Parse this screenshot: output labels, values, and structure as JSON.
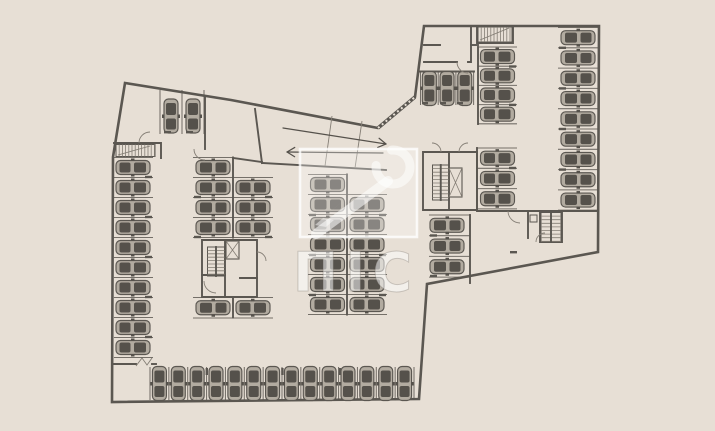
{
  "canvas": {
    "w": 715,
    "h": 431,
    "bg": "#e7dfd5",
    "wall": "#5b5751",
    "thin": "#847e75",
    "arrow": "#55514b",
    "car_dark": "#55514b",
    "car_body": "#b2aba0",
    "white": "#ffffff"
  },
  "watermark": {
    "letters": "ПІС",
    "square": [
      300,
      149,
      117,
      88
    ],
    "letters_center": [
      356,
      291
    ]
  },
  "plan": {
    "outline": [
      [
        125,
        83
      ],
      [
        231,
        100
      ],
      [
        378,
        128
      ],
      [
        415,
        97
      ],
      [
        424,
        26
      ],
      [
        599,
        26
      ],
      [
        598,
        252
      ],
      [
        427,
        284
      ],
      [
        419,
        399
      ],
      [
        112,
        402
      ],
      [
        113,
        157
      ],
      [
        125,
        83
      ]
    ],
    "hatched": [
      [
        [
          378,
          128
        ],
        [
          415,
          97
        ]
      ]
    ],
    "walls": [
      [
        [
          114,
          143
        ],
        [
          161,
          143
        ],
        [
          161,
          158
        ]
      ],
      [
        [
          205,
          96
        ],
        [
          205,
          149
        ]
      ],
      [
        [
          255,
          109
        ],
        [
          262,
          163
        ]
      ],
      [
        [
          262,
          163
        ],
        [
          386,
          170
        ]
      ],
      [
        [
          233,
          158
        ],
        [
          262,
          162
        ]
      ],
      [
        [
          233,
          157.5
        ],
        [
          233,
          237.5
        ]
      ],
      [
        [
          233,
          297.5
        ],
        [
          233,
          317.5
        ]
      ],
      [
        [
          347,
          174.5
        ],
        [
          347,
          314.5
        ]
      ],
      [
        [
          202,
          240
        ],
        [
          257,
          240
        ],
        [
          257,
          297
        ],
        [
          202,
          297
        ],
        [
          202,
          240
        ]
      ],
      [
        [
          225,
          240
        ],
        [
          225,
          297
        ]
      ],
      [
        [
          202,
          275
        ],
        [
          225,
          275
        ]
      ],
      [
        [
          240,
          278
        ],
        [
          257,
          278
        ]
      ],
      [
        [
          423,
          152
        ],
        [
          477,
          152
        ],
        [
          477,
          210
        ],
        [
          423,
          210
        ],
        [
          423,
          152
        ]
      ],
      [
        [
          449,
          152
        ],
        [
          449,
          210
        ]
      ],
      [
        [
          424,
          62
        ],
        [
          457,
          62
        ]
      ],
      [
        [
          468,
          62
        ],
        [
          471,
          62
        ],
        [
          471,
          26
        ]
      ],
      [
        [
          471,
          45
        ],
        [
          478,
          45
        ]
      ],
      [
        [
          424,
          45
        ],
        [
          440,
          45
        ]
      ],
      [
        [
          477,
          26
        ],
        [
          477,
          43
        ],
        [
          513,
          43
        ],
        [
          513,
          26
        ]
      ],
      [
        [
          419,
          71.5
        ],
        [
          474,
          71.5
        ]
      ],
      [
        [
          478,
          47
        ],
        [
          478,
          124
        ]
      ],
      [
        [
          477,
          148
        ],
        [
          477,
          209
        ]
      ],
      [
        [
          477,
          211
        ],
        [
          598,
          211
        ]
      ],
      [
        [
          540,
          211
        ],
        [
          540,
          242
        ],
        [
          562,
          242
        ],
        [
          562,
          211
        ]
      ],
      [
        [
          528,
          211
        ],
        [
          528,
          238
        ]
      ],
      [
        [
          470,
          215
        ],
        [
          470,
          283
        ]
      ],
      [
        [
          114,
          364
        ],
        [
          136,
          364
        ]
      ],
      [
        [
          152,
          364
        ],
        [
          156,
          364
        ]
      ]
    ],
    "thin": [
      [
        [
          332,
          116
        ],
        [
          325,
          166
        ]
      ],
      [
        [
          362,
          121
        ],
        [
          355,
          168
        ]
      ],
      [
        [
          118,
          155
        ],
        [
          150,
          146
        ]
      ],
      [
        [
          480,
          40
        ],
        [
          509,
          28
        ]
      ],
      [
        [
          136,
          366
        ],
        [
          142,
          358
        ],
        [
          147,
          365
        ],
        [
          152,
          358
        ]
      ]
    ],
    "stall_groups": [
      {
        "name": "left-wall-column",
        "orient": "h",
        "x1": 114,
        "x2": 153,
        "start": 157.5,
        "step": 20,
        "count": 10,
        "carC": 133,
        "rot": 0
      },
      {
        "name": "center-left-col-west",
        "orient": "h",
        "x1": 193,
        "x2": 233,
        "start": 157.5,
        "step": 20,
        "count": 4,
        "carC": 213,
        "rot": 180
      },
      {
        "name": "center-left-col-east",
        "orient": "h",
        "x1": 233,
        "x2": 273,
        "start": 177.5,
        "step": 20,
        "count": 3,
        "carC": 253,
        "rot": 0
      },
      {
        "name": "center-left-col-west-lower",
        "orient": "h",
        "x1": 193,
        "x2": 233,
        "start": 297.5,
        "step": 20.5,
        "count": 1,
        "carC": 213,
        "rot": 180
      },
      {
        "name": "center-left-col-east-lower",
        "orient": "h",
        "x1": 233,
        "x2": 273,
        "start": 297.5,
        "step": 20.5,
        "count": 1,
        "carC": 253,
        "rot": 0
      },
      {
        "name": "center-right-col-west",
        "orient": "h",
        "x1": 308,
        "x2": 347,
        "start": 174.5,
        "step": 20,
        "count": 7,
        "carC": 327.5,
        "rot": 180
      },
      {
        "name": "center-right-col-east",
        "orient": "h",
        "x1": 347,
        "x2": 387,
        "start": 194.5,
        "step": 20,
        "count": 6,
        "carC": 367,
        "rot": 0
      },
      {
        "name": "mid-column-upper",
        "orient": "h",
        "x1": 478,
        "x2": 517,
        "start": 47,
        "step": 19.2,
        "count": 4,
        "carC": 497.5,
        "rot": 0
      },
      {
        "name": "mid-column-lower",
        "orient": "h",
        "x1": 477,
        "x2": 517,
        "start": 148,
        "step": 20.3,
        "count": 3,
        "carC": 497.5,
        "rot": 0
      },
      {
        "name": "right-inner-column",
        "orient": "h",
        "x1": 429,
        "x2": 470,
        "start": 215,
        "step": 20.7,
        "count": 3,
        "carC": 447,
        "rot": 180
      },
      {
        "name": "right-wall-column",
        "orient": "h",
        "x1": 558,
        "x2": 598,
        "start": 27.5,
        "step": 20.3,
        "count": 9,
        "carC": 578,
        "rot": 180
      },
      {
        "name": "bottom-row",
        "orient": "v",
        "y1": 367,
        "y2": 400,
        "start": 150,
        "step": 18.857,
        "count": 14,
        "carC": 383.5,
        "rot": -90
      },
      {
        "name": "top-left-vertical",
        "orient": "v",
        "y1": 90,
        "y2": 134,
        "start": 160,
        "step": 22,
        "count": 2,
        "carC": 116,
        "rot": -90
      },
      {
        "name": "top-right-vertical",
        "orient": "v",
        "y1": 72,
        "y2": 105,
        "start": 420.5,
        "step": 17.7,
        "count": 3,
        "carC": 88.5,
        "rot": 90
      }
    ],
    "stairs": [
      {
        "x": 116,
        "y": 144.5,
        "w": 39,
        "h": 12,
        "dir": "v",
        "step": 3.2,
        "mid": false
      },
      {
        "x": 478,
        "y": 27,
        "w": 34,
        "h": 15,
        "dir": "v",
        "step": 3.2,
        "mid": false
      },
      {
        "x": 207.5,
        "y": 247,
        "w": 17,
        "h": 29,
        "dir": "h",
        "step": 3.4,
        "mid": true
      },
      {
        "x": 432.5,
        "y": 165,
        "w": 16.5,
        "h": 35,
        "dir": "h",
        "step": 3.6,
        "mid": true
      },
      {
        "x": 541,
        "y": 212.5,
        "w": 20,
        "h": 29,
        "dir": "h",
        "step": 3.6,
        "mid": true
      }
    ],
    "elevators": [
      [
        226,
        241,
        13,
        18
      ],
      [
        449,
        168,
        13,
        29
      ]
    ],
    "boxes": [
      [
        530,
        215,
        7,
        7
      ]
    ],
    "arcs": [
      "M139 143 A11 11 0 0 1 150 132",
      "M194 149 A11 11 0 0 0 205 160",
      "M457 62 A11 11 0 0 0 468 73",
      "M432 143 A9 9 0 0 1 441 152",
      "M468 143 A9 9 0 0 0 459 152",
      "M508 211 A12 12 0 0 0 520 223",
      "M536 242 A9 9 0 0 1 545 233",
      "M204 281 A12 12 0 0 0 216 293",
      "M257 252 A9 9 0 0 1 266 261"
    ],
    "arrows": [
      {
        "x1": 283,
        "y1": 128,
        "x2": 386,
        "y2": 144
      },
      {
        "x1": 383,
        "y1": 153,
        "x2": 287,
        "y2": 152
      }
    ],
    "ticks": [
      [
        145,
        175.8,
        7,
        2.4
      ],
      [
        145,
        215.8,
        7,
        2.4
      ],
      [
        145,
        255.8,
        7,
        2.4
      ],
      [
        145,
        295.8,
        7,
        2.4
      ],
      [
        145,
        335.8,
        7,
        2.4
      ],
      [
        194,
        195.8,
        7,
        2.4
      ],
      [
        194,
        235.8,
        7,
        2.4
      ],
      [
        265,
        195.8,
        7,
        2.4
      ],
      [
        265,
        235.8,
        7,
        2.4
      ],
      [
        309,
        213.8,
        7,
        2.4
      ],
      [
        309,
        253.8,
        7,
        2.4
      ],
      [
        309,
        293.8,
        7,
        2.4
      ],
      [
        379,
        213.8,
        7,
        2.4
      ],
      [
        379,
        253.8,
        7,
        2.4
      ],
      [
        379,
        293.8,
        7,
        2.4
      ],
      [
        509,
        65.3,
        7,
        2.4
      ],
      [
        509,
        103.7,
        7,
        2.4
      ],
      [
        509,
        166.8,
        7,
        2.4
      ],
      [
        430,
        234.3,
        7,
        2.4
      ],
      [
        430,
        274.8,
        7,
        2.4
      ],
      [
        559,
        46.6,
        7,
        2.4
      ],
      [
        559,
        87.2,
        7,
        2.4
      ],
      [
        559,
        127.8,
        7,
        2.4
      ],
      [
        559,
        168.4,
        7,
        2.4
      ],
      [
        205.6,
        368,
        2.4,
        7
      ],
      [
        281.2,
        368,
        2.4,
        7
      ],
      [
        338.8,
        368,
        2.4,
        7
      ],
      [
        164,
        131,
        7,
        2.4
      ],
      [
        186,
        131,
        7,
        2.4
      ],
      [
        422,
        102,
        6,
        2.4
      ],
      [
        440,
        102,
        6,
        2.4
      ],
      [
        457,
        102,
        6,
        2.4
      ],
      [
        510,
        251,
        7,
        2.4
      ]
    ]
  }
}
